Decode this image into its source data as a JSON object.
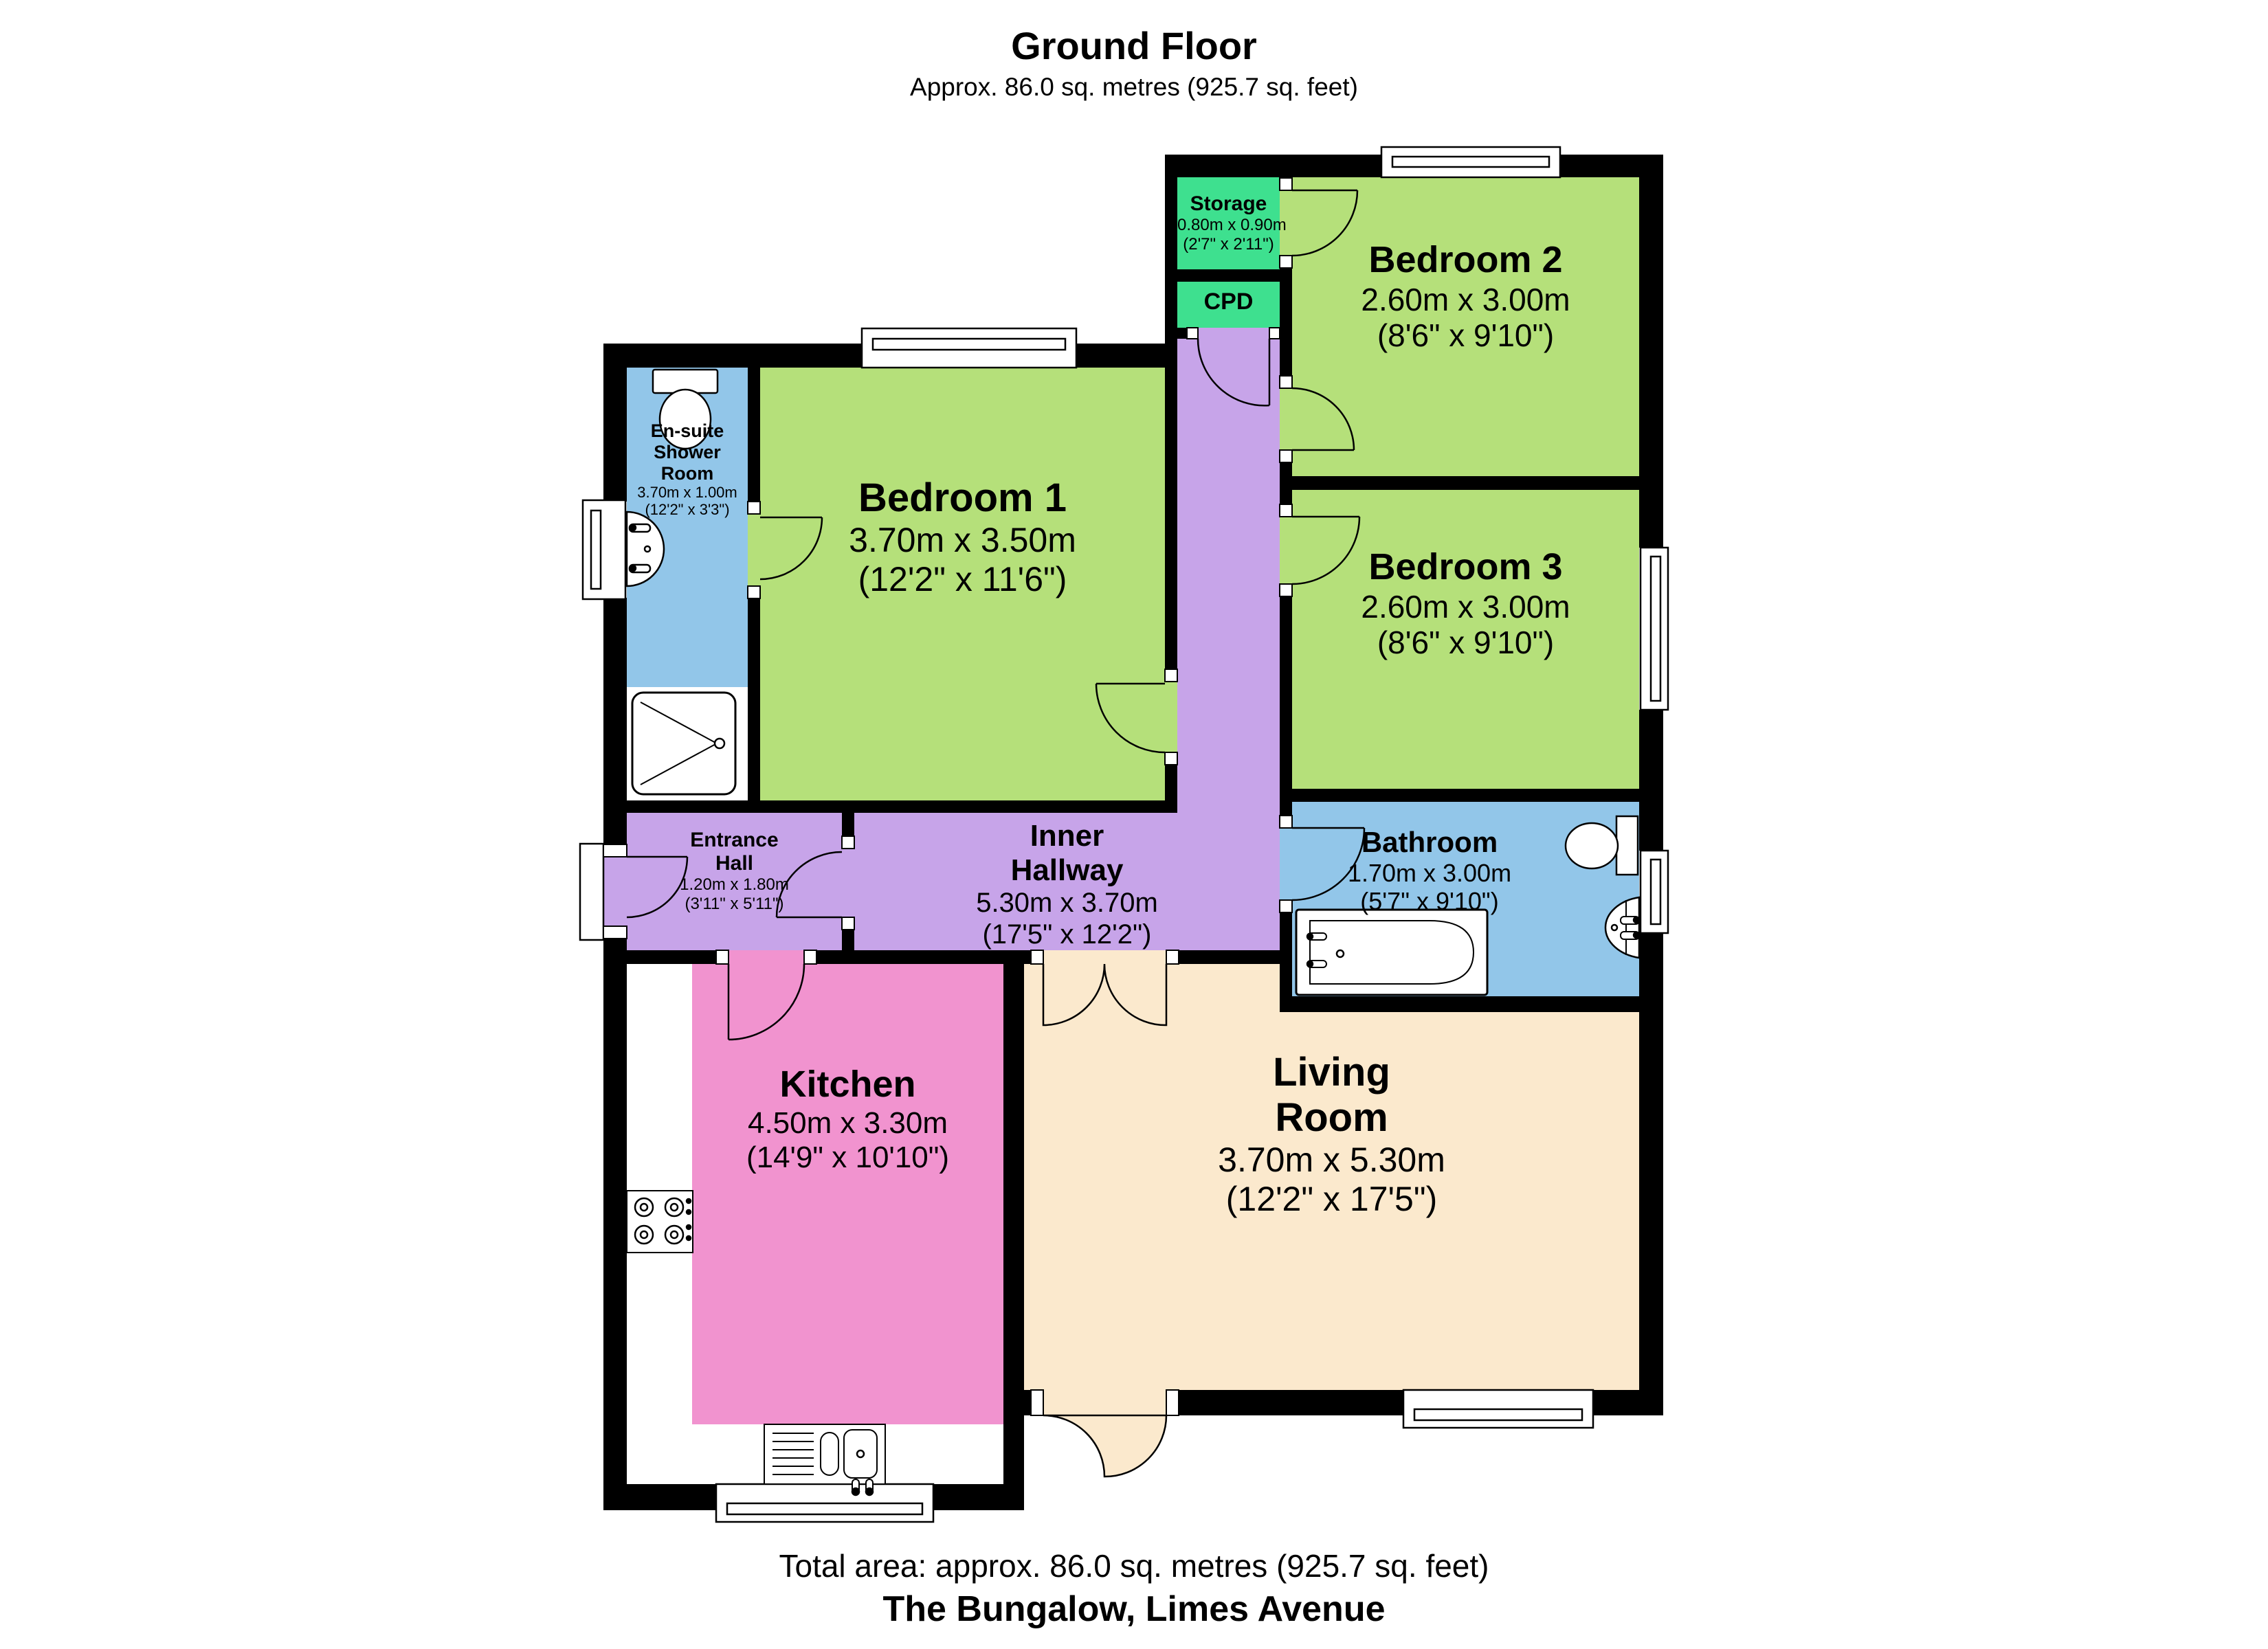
{
  "header": {
    "title": "Ground Floor",
    "subtitle": "Approx. 86.0 sq. metres (925.7 sq. feet)"
  },
  "footer": {
    "total_area": "Total area: approx. 86.0 sq. metres (925.7 sq. feet)",
    "address": "The Bungalow, Limes Avenue"
  },
  "rooms": {
    "storage": {
      "name": "Storage",
      "dims_m": "0.80m x 0.90m",
      "dims_ft": "(2'7\" x 2'11\")"
    },
    "cpd": {
      "name": "CPD"
    },
    "bedroom2": {
      "name": "Bedroom 2",
      "dims_m": "2.60m x 3.00m",
      "dims_ft": "(8'6\" x 9'10\")"
    },
    "bedroom3": {
      "name": "Bedroom 3",
      "dims_m": "2.60m x 3.00m",
      "dims_ft": "(8'6\" x 9'10\")"
    },
    "bathroom": {
      "name": "Bathroom",
      "dims_m": "1.70m x 3.00m",
      "dims_ft": "(5'7\" x 9'10\")"
    },
    "ensuite": {
      "name1": "En-suite",
      "name2": "Shower",
      "name3": "Room",
      "dims_m": "3.70m x 1.00m",
      "dims_ft": "(12'2\" x 3'3\")"
    },
    "bedroom1": {
      "name": "Bedroom 1",
      "dims_m": "3.70m x 3.50m",
      "dims_ft": "(12'2\" x 11'6\")"
    },
    "entrance_hall": {
      "name1": "Entrance",
      "name2": "Hall",
      "dims_m": "1.20m x 1.80m",
      "dims_ft": "(3'11\" x 5'11\")"
    },
    "inner_hallway": {
      "name1": "Inner",
      "name2": "Hallway",
      "dims_m": "5.30m x 3.70m",
      "dims_ft": "(17'5\" x 12'2\")"
    },
    "kitchen": {
      "name": "Kitchen",
      "dims_m": "4.50m x 3.30m",
      "dims_ft": "(14'9\" x 10'10\")"
    },
    "living_room": {
      "name1": "Living",
      "name2": "Room",
      "dims_m": "3.70m x 5.30m",
      "dims_ft": "(12'2\" x 17'5\")"
    }
  },
  "colors": {
    "wall": "#000000",
    "bedroom_green": "#b5e07a",
    "cupboard_green": "#3ee08f",
    "wet_room_blue": "#92c6e9",
    "hallway_purple": "#c7a4e9",
    "kitchen_pink": "#f193cf",
    "living_cream": "#fbe9cd",
    "fixture_white": "#ffffff",
    "text": "#000000"
  }
}
